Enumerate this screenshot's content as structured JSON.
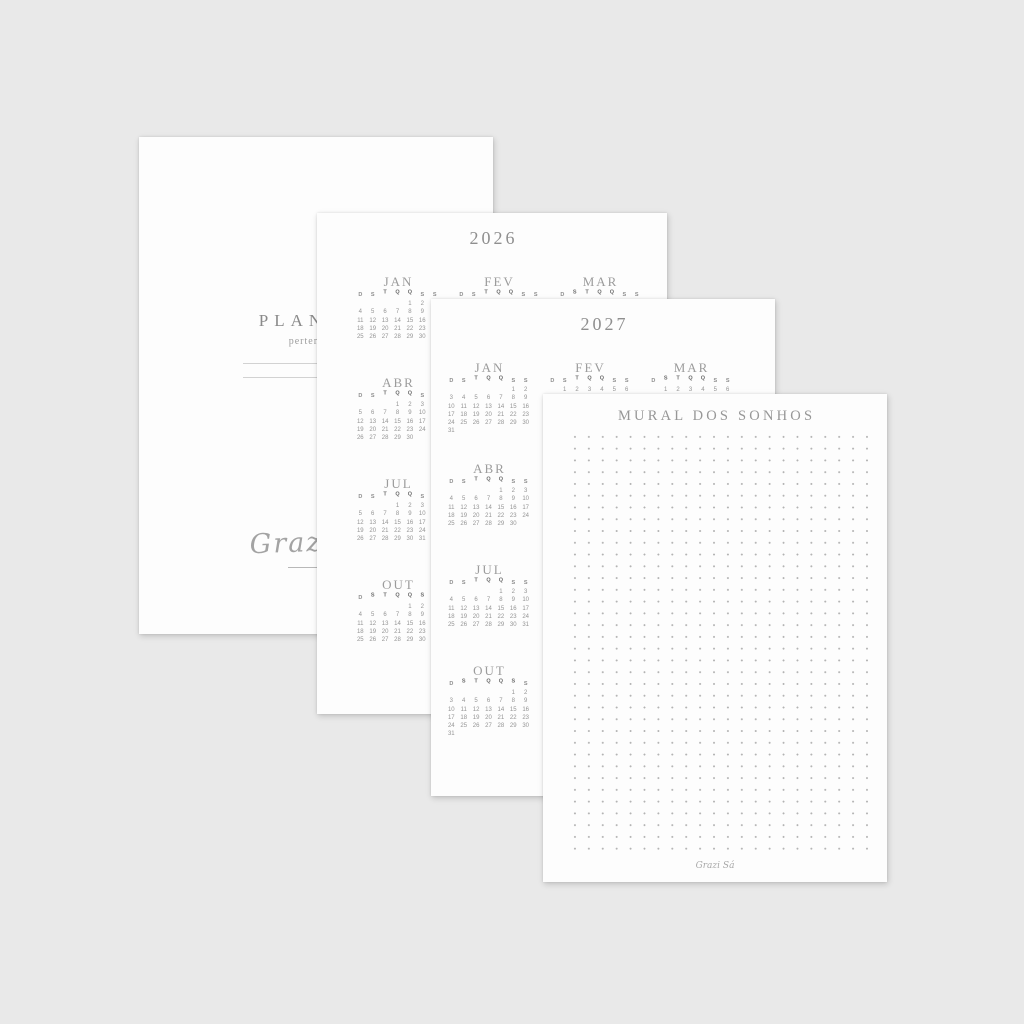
{
  "backdrop_color": "#e9e9e9",
  "page_color": "#fdfdfd",
  "colors": {
    "heading_ink": "#8f8f8f",
    "month_title_ink": "#9c9c9c",
    "day_letter_ink": "#8d8d8d",
    "day_letter_bold_ink": "#6a6a6a",
    "date_ink": "#949494",
    "dot_ink": "#b3b3b3",
    "fill_line": "#d2d2d2",
    "signature_ink": "#a3a3a3"
  },
  "pages": {
    "cover": {
      "title": "PLANNER",
      "subtitle": "pertence a:",
      "fill_in_lines": 2,
      "signature": "Grazi Sá"
    },
    "year2026": {
      "title": "2026",
      "day_headers": [
        "D",
        "S",
        "T",
        "Q",
        "Q",
        "S",
        "S"
      ],
      "months": [
        {
          "name": "JAN",
          "col": 1,
          "row": 1,
          "raised": [
            2,
            3,
            4
          ],
          "weeks": [
            [
              "",
              "",
              "",
              "",
              "1",
              "2",
              "3"
            ],
            [
              "4",
              "5",
              "6",
              "7",
              "8",
              "9",
              "10"
            ],
            [
              "11",
              "12",
              "13",
              "14",
              "15",
              "16",
              "17"
            ],
            [
              "18",
              "19",
              "20",
              "21",
              "22",
              "23",
              "24"
            ],
            [
              "25",
              "26",
              "27",
              "28",
              "29",
              "30",
              "31"
            ]
          ]
        },
        {
          "name": "FEV",
          "col": 2,
          "row": 1,
          "raised": [
            2,
            3,
            4
          ],
          "weeks": [
            [
              "1",
              "2",
              "3",
              "4",
              "5",
              "6",
              "7"
            ],
            [
              "8",
              "9",
              "10",
              "11",
              "12",
              "13",
              "14"
            ],
            [
              "15",
              "16",
              "17",
              "18",
              "19",
              "20",
              "21"
            ],
            [
              "22",
              "23",
              "24",
              "25",
              "26",
              "27",
              "28"
            ]
          ]
        },
        {
          "name": "MAR",
          "col": 3,
          "row": 1,
          "raised": [
            1,
            2,
            3,
            4
          ],
          "weeks": [
            [
              "1",
              "2",
              "3",
              "4",
              "5",
              "6",
              "7"
            ],
            [
              "8",
              "9",
              "10",
              "11",
              "12",
              "13",
              "14"
            ],
            [
              "15",
              "16",
              "17",
              "18",
              "19",
              "20",
              "21"
            ],
            [
              "22",
              "23",
              "24",
              "25",
              "26",
              "27",
              "28"
            ],
            [
              "29",
              "30",
              "31",
              "",
              "",
              "",
              ""
            ]
          ]
        },
        {
          "name": "ABR",
          "col": 1,
          "row": 2,
          "raised": [
            2,
            3,
            4
          ],
          "weeks": [
            [
              "",
              "",
              "",
              "1",
              "2",
              "3",
              "4"
            ],
            [
              "5",
              "6",
              "7",
              "8",
              "9",
              "10",
              "11"
            ],
            [
              "12",
              "13",
              "14",
              "15",
              "16",
              "17",
              "18"
            ],
            [
              "19",
              "20",
              "21",
              "22",
              "23",
              "24",
              "25"
            ],
            [
              "26",
              "27",
              "28",
              "29",
              "30",
              "",
              ""
            ]
          ]
        },
        {
          "name": "JUL",
          "col": 1,
          "row": 3,
          "raised": [
            2,
            3,
            4
          ],
          "weeks": [
            [
              "",
              "",
              "",
              "1",
              "2",
              "3",
              "4"
            ],
            [
              "5",
              "6",
              "7",
              "8",
              "9",
              "10",
              "11"
            ],
            [
              "12",
              "13",
              "14",
              "15",
              "16",
              "17",
              "18"
            ],
            [
              "19",
              "20",
              "21",
              "22",
              "23",
              "24",
              "25"
            ],
            [
              "26",
              "27",
              "28",
              "29",
              "30",
              "31",
              ""
            ]
          ]
        },
        {
          "name": "OUT",
          "col": 1,
          "row": 4,
          "raised": [
            1,
            2,
            3,
            4,
            5
          ],
          "weeks": [
            [
              "",
              "",
              "",
              "",
              "1",
              "2",
              "3"
            ],
            [
              "4",
              "5",
              "6",
              "7",
              "8",
              "9",
              "10"
            ],
            [
              "11",
              "12",
              "13",
              "14",
              "15",
              "16",
              "17"
            ],
            [
              "18",
              "19",
              "20",
              "21",
              "22",
              "23",
              "24"
            ],
            [
              "25",
              "26",
              "27",
              "28",
              "29",
              "30",
              "31"
            ]
          ]
        }
      ]
    },
    "year2027": {
      "title": "2027",
      "day_headers": [
        "D",
        "S",
        "T",
        "Q",
        "Q",
        "S",
        "S"
      ],
      "months": [
        {
          "name": "JAN",
          "col": 1,
          "row": 1,
          "raised": [
            2,
            3,
            4
          ],
          "weeks": [
            [
              "",
              "",
              "",
              "",
              "",
              "1",
              "2"
            ],
            [
              "3",
              "4",
              "5",
              "6",
              "7",
              "8",
              "9"
            ],
            [
              "10",
              "11",
              "12",
              "13",
              "14",
              "15",
              "16"
            ],
            [
              "17",
              "18",
              "19",
              "20",
              "21",
              "22",
              "23"
            ],
            [
              "24",
              "25",
              "26",
              "27",
              "28",
              "29",
              "30"
            ],
            [
              "31",
              "",
              "",
              "",
              "",
              "",
              ""
            ]
          ]
        },
        {
          "name": "FEV",
          "col": 2,
          "row": 1,
          "raised": [
            2,
            3,
            4
          ],
          "weeks": [
            [
              "",
              "1",
              "2",
              "3",
              "4",
              "5",
              "6"
            ],
            [
              "7",
              "8",
              "9",
              "10",
              "11",
              "12",
              "13"
            ],
            [
              "14",
              "15",
              "16",
              "17",
              "18",
              "19",
              "20"
            ],
            [
              "21",
              "22",
              "23",
              "24",
              "25",
              "26",
              "27"
            ],
            [
              "28",
              "",
              "",
              "",
              "",
              "",
              ""
            ]
          ]
        },
        {
          "name": "MAR",
          "col": 3,
          "row": 1,
          "raised": [
            1,
            2,
            3,
            4
          ],
          "weeks": [
            [
              "",
              "1",
              "2",
              "3",
              "4",
              "5",
              "6"
            ],
            [
              "7",
              "8",
              "9",
              "10",
              "11",
              "12",
              "13"
            ],
            [
              "14",
              "15",
              "16",
              "17",
              "18",
              "19",
              "20"
            ],
            [
              "21",
              "22",
              "23",
              "24",
              "25",
              "26",
              "27"
            ],
            [
              "28",
              "29",
              "30",
              "31",
              "",
              "",
              ""
            ]
          ]
        },
        {
          "name": "ABR",
          "col": 1,
          "row": 2,
          "raised": [
            2,
            3,
            4
          ],
          "weeks": [
            [
              "",
              "",
              "",
              "",
              "1",
              "2",
              "3"
            ],
            [
              "4",
              "5",
              "6",
              "7",
              "8",
              "9",
              "10"
            ],
            [
              "11",
              "12",
              "13",
              "14",
              "15",
              "16",
              "17"
            ],
            [
              "18",
              "19",
              "20",
              "21",
              "22",
              "23",
              "24"
            ],
            [
              "25",
              "26",
              "27",
              "28",
              "29",
              "30",
              ""
            ]
          ]
        },
        {
          "name": "JUL",
          "col": 1,
          "row": 3,
          "raised": [
            2,
            3,
            4
          ],
          "weeks": [
            [
              "",
              "",
              "",
              "",
              "1",
              "2",
              "3"
            ],
            [
              "4",
              "5",
              "6",
              "7",
              "8",
              "9",
              "10"
            ],
            [
              "11",
              "12",
              "13",
              "14",
              "15",
              "16",
              "17"
            ],
            [
              "18",
              "19",
              "20",
              "21",
              "22",
              "23",
              "24"
            ],
            [
              "25",
              "26",
              "27",
              "28",
              "29",
              "30",
              "31"
            ]
          ]
        },
        {
          "name": "OUT",
          "col": 1,
          "row": 4,
          "raised": [
            1,
            2,
            3,
            4,
            5
          ],
          "weeks": [
            [
              "",
              "",
              "",
              "",
              "",
              "1",
              "2"
            ],
            [
              "3",
              "4",
              "5",
              "6",
              "7",
              "8",
              "9"
            ],
            [
              "10",
              "11",
              "12",
              "13",
              "14",
              "15",
              "16"
            ],
            [
              "17",
              "18",
              "19",
              "20",
              "21",
              "22",
              "23"
            ],
            [
              "24",
              "25",
              "26",
              "27",
              "28",
              "29",
              "30"
            ],
            [
              "31",
              "",
              "",
              "",
              "",
              "",
              ""
            ]
          ]
        }
      ]
    },
    "mural": {
      "title": "MURAL DOS SONHOS",
      "dot_grid": {
        "cols": 23,
        "rows": 37
      },
      "signature": "Grazi Sá"
    }
  }
}
